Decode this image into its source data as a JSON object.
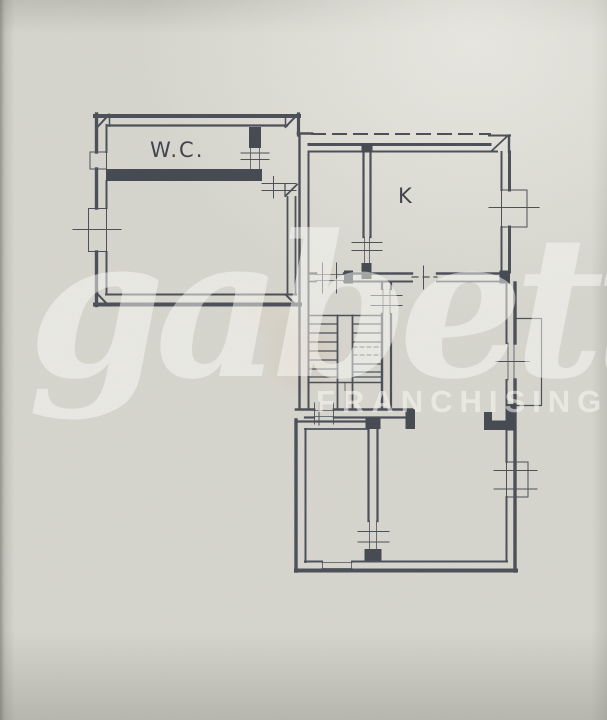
{
  "plan": {
    "labels": {
      "wc": "W.C.",
      "kitchen": "K"
    },
    "watermark": {
      "brand": "gabetti",
      "subtitle": "FRANCHISING"
    },
    "colors": {
      "paper": "#d7d6ce",
      "ink": "#494d56",
      "wall_fill": "#43474f",
      "watermark": "rgba(250,250,244,0.55)"
    }
  }
}
